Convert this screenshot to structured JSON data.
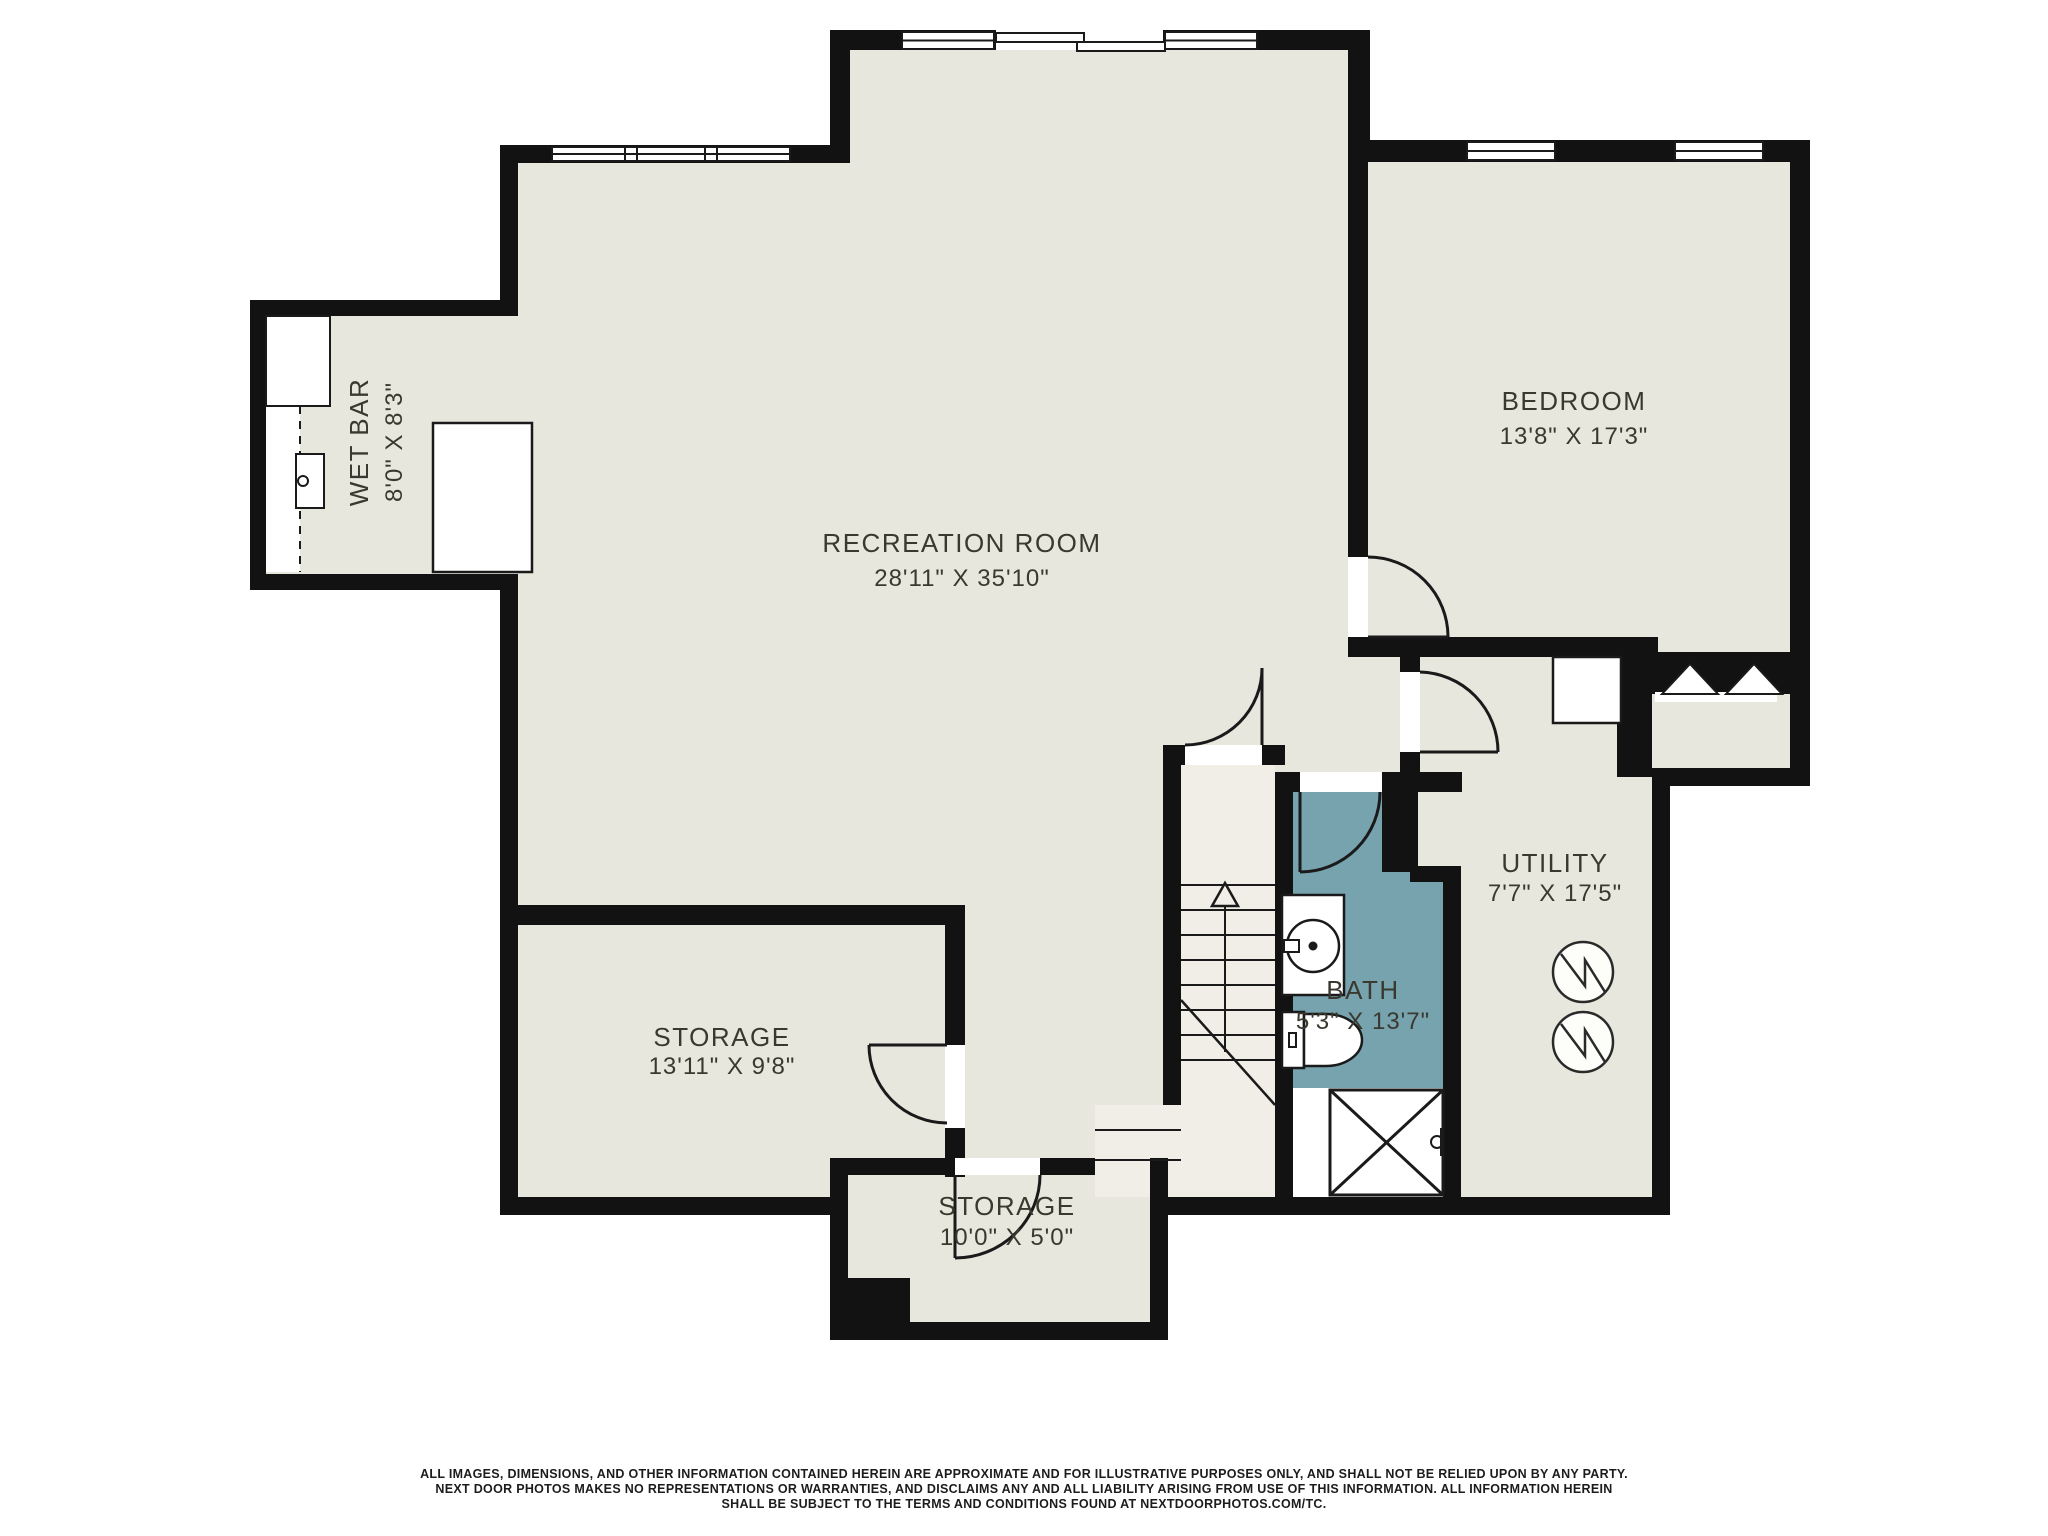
{
  "title": "Basement Floor Plan",
  "colors": {
    "floor": "#e8e7de",
    "wall": "#121212",
    "bath_floor": "#76a3ae",
    "stairs_floor": "#f0eee7",
    "fixture_fill": "#ffffff",
    "label_text": "#3a392f"
  },
  "rooms": {
    "recreation": {
      "name": "RECREATION ROOM",
      "dims": "28'11\" X 35'10\""
    },
    "bedroom": {
      "name": "BEDROOM",
      "dims": "13'8\" X 17'3\""
    },
    "wet_bar": {
      "name": "WET BAR",
      "dims": "8'0\" X 8'3\""
    },
    "storage_left": {
      "name": "STORAGE",
      "dims": "13'11\" X 9'8\""
    },
    "storage_lower": {
      "name": "STORAGE",
      "dims": "10'0\" X 5'0\""
    },
    "utility": {
      "name": "UTILITY",
      "dims": "7'7\" X 17'5\""
    },
    "bath": {
      "name": "BATH",
      "dims": "5'3\" X 13'7\""
    }
  },
  "disclaimer": {
    "line1": "ALL IMAGES, DIMENSIONS, AND OTHER INFORMATION CONTAINED HEREIN ARE APPROXIMATE AND FOR ILLUSTRATIVE PURPOSES ONLY, AND SHALL NOT BE RELIED UPON BY ANY PARTY.",
    "line2": "NEXT DOOR PHOTOS MAKES NO REPRESENTATIONS OR WARRANTIES, AND DISCLAIMS ANY AND ALL LIABILITY ARISING FROM USE OF THIS INFORMATION. ALL INFORMATION HEREIN",
    "line3": "SHALL BE SUBJECT TO THE TERMS AND CONDITIONS FOUND AT NEXTDOORPHOTOS.COM/TC."
  }
}
